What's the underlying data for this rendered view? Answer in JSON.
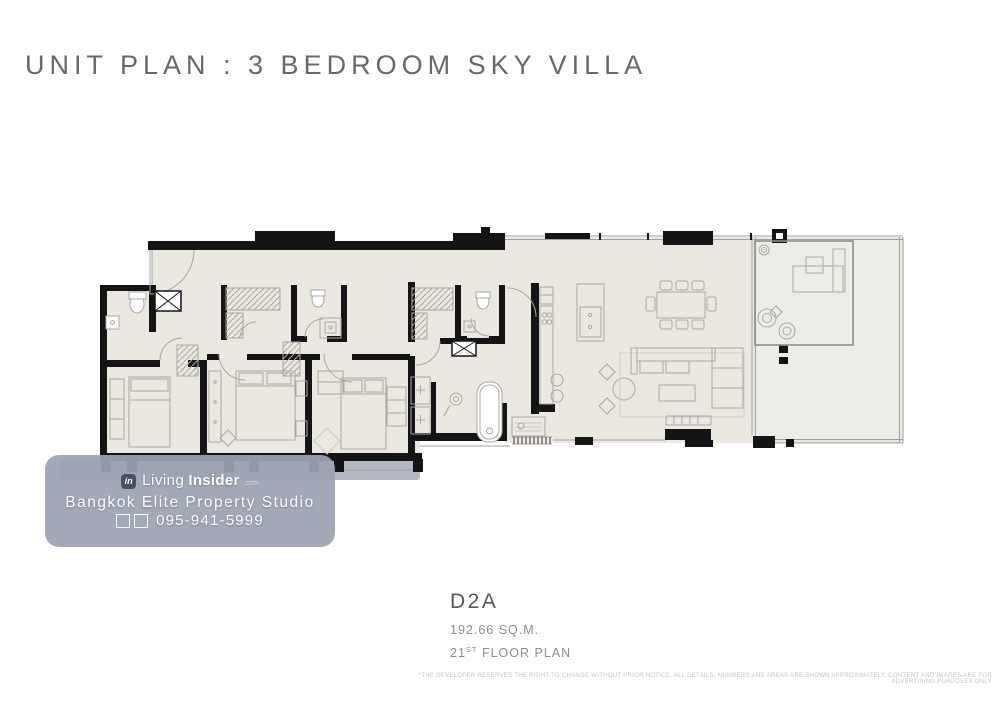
{
  "page": {
    "title": "UNIT PLAN : 3 BEDROOM SKY VILLA",
    "background": "#ffffff"
  },
  "unit_info": {
    "code": "D2A",
    "area": "192.66 SQ.M.",
    "floor_number": "21",
    "floor_ordinal": "ST",
    "floor_label": " FLOOR PLAN"
  },
  "watermark": {
    "logo_glyph": "in",
    "brand_prefix": "Living",
    "brand_suffix": "Insider",
    "brand_tld": ".com",
    "studio": "Bangkok Elite Property Studio",
    "phone": "095-941-5999"
  },
  "disclaimer": "*THE DEVELOPER RESERVES THE RIGHT TO CHANGE WITHOUT PRIOR NOTICE. ALL DETAILS, NUMBERS AND AREAS ARE SHOWN APPROXIMATELY. CONTENT AND IMAGES ARE FOR ADVERTISING PURPOSES ONLY",
  "colors": {
    "title_text": "#66696f",
    "subtitle_text": "#8b8e93",
    "walls": "#141414",
    "floor_fill": "#eae8e1",
    "terrace_fill": "#edece6",
    "fixture_line": "#a9a8a0",
    "ledge": "#b5b9c4",
    "watermark_panel": "#9ca2b3",
    "watermark_text": "#ffffff",
    "disclaimer_text": "#c4c4c6"
  },
  "floorplan": {
    "rooms_depicted": [
      "foyer",
      "bedroom-2",
      "bedroom-3",
      "master-bedroom",
      "bathroom-2",
      "bathroom-3",
      "master-bathroom",
      "walk-in-closets",
      "corridor",
      "kitchen",
      "dining-area",
      "living-area",
      "terrace"
    ]
  }
}
